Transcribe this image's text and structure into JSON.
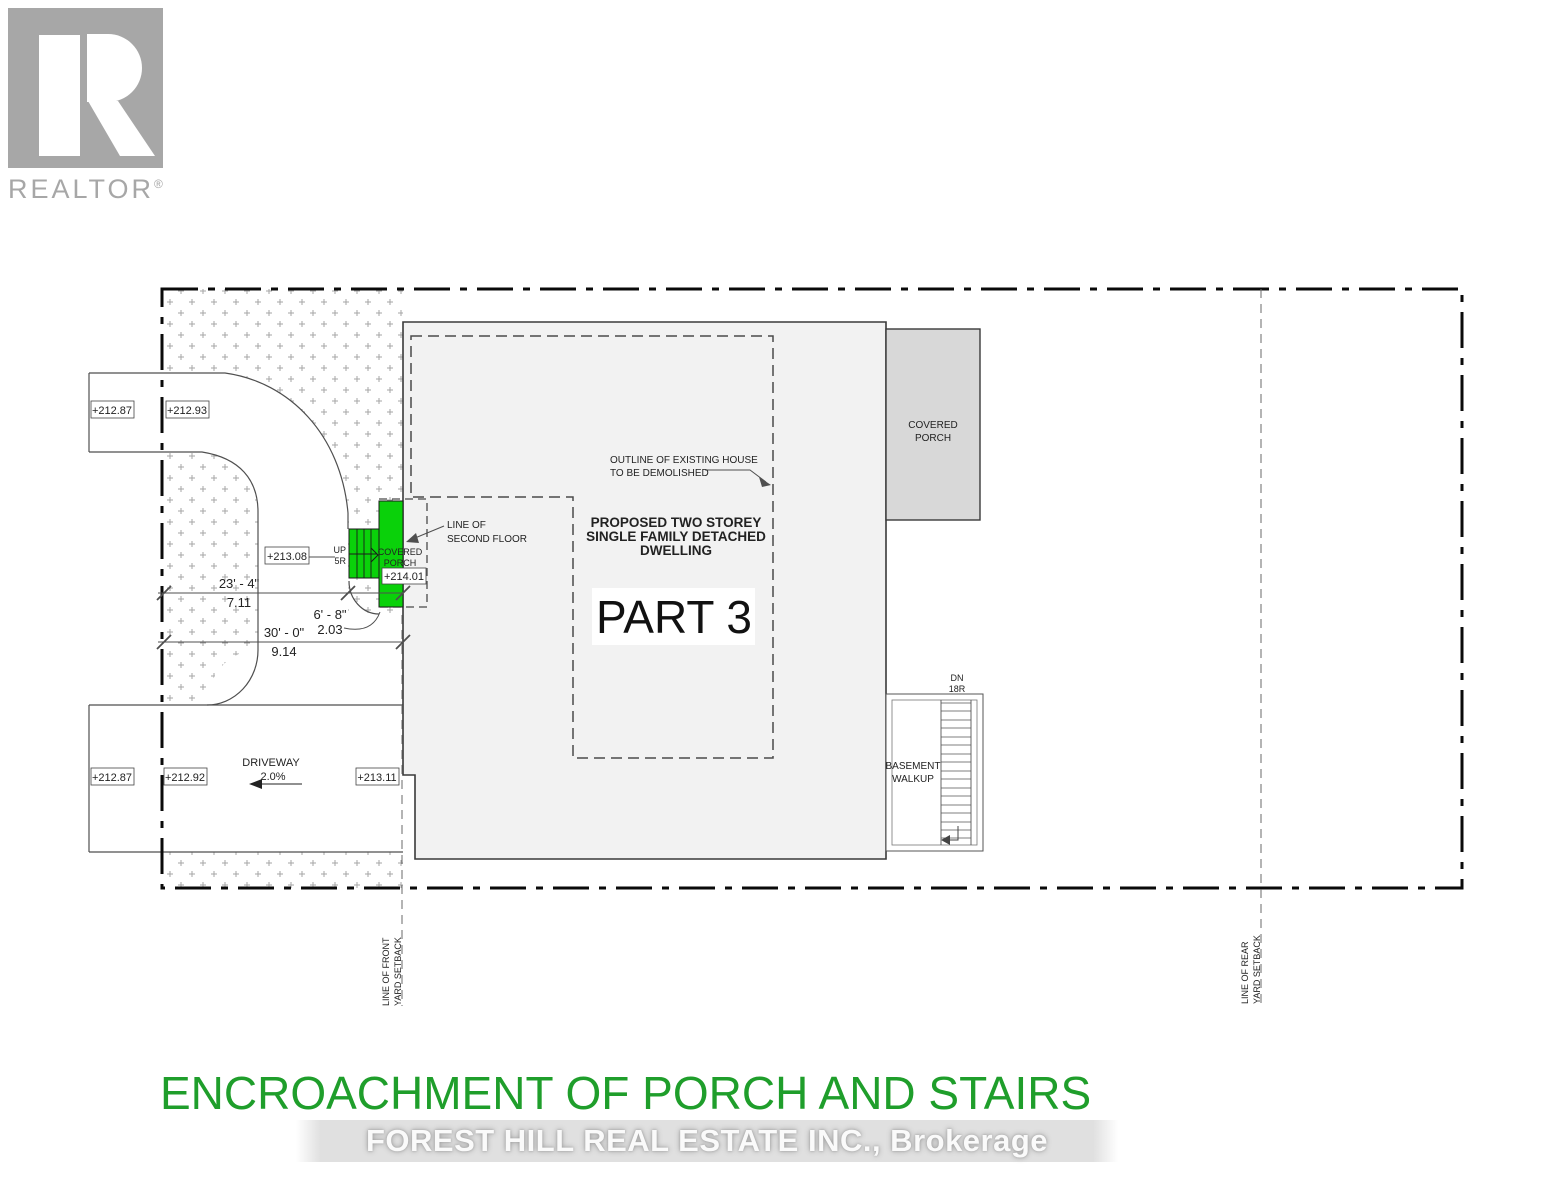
{
  "logo": {
    "brand": "REALTOR",
    "registered": "®"
  },
  "plan": {
    "elevations": {
      "walk_street": "+212.87",
      "walk_inside": "+212.93",
      "stair_base": "+213.08",
      "porch_top": "+214.01",
      "drive_street": "+212.87",
      "drive_inside": "+212.92",
      "drive_house": "+213.11"
    },
    "labels": {
      "outline_line1": "OUTLINE OF EXISTING HOUSE",
      "outline_line2": "TO BE DEMOLISHED",
      "proposed_line1": "PROPOSED TWO STOREY",
      "proposed_line2": "SINGLE FAMILY DETACHED",
      "proposed_line3": "DWELLING",
      "part": "PART 3",
      "covered": "COVERED",
      "porch": "PORCH",
      "line_of": "LINE OF",
      "second_floor": "SECOND FLOOR",
      "up": "UP",
      "up_risers": "5R",
      "dn": "DN",
      "dn_risers": "18R",
      "basement": "BASEMENT",
      "walkup": "WALKUP",
      "driveway": "DRIVEWAY",
      "slope": "2.0%",
      "front_setback_line1": "LINE OF FRONT",
      "front_setback_line2": "YARD SETBACK",
      "rear_setback_line1": "LINE OF REAR",
      "rear_setback_line2": "YARD SETBACK"
    },
    "dimensions": {
      "d1_imperial": "23' - 4\"",
      "d1_metric": "7.11",
      "d2_imperial": "30' - 0\"",
      "d2_metric": "9.14",
      "d3_imperial": "6' - 8\"",
      "d3_metric": "2.03"
    }
  },
  "footer": {
    "title": "ENCROACHMENT OF PORCH AND STAIRS",
    "watermark": "FOREST HILL REAL ESTATE INC.,  Brokerage"
  },
  "colors": {
    "highlight_green": "#0ad10a",
    "title_green": "#1f9e2b",
    "building_fill": "#f2f2f2",
    "porch_fill": "#d8d8d8"
  }
}
